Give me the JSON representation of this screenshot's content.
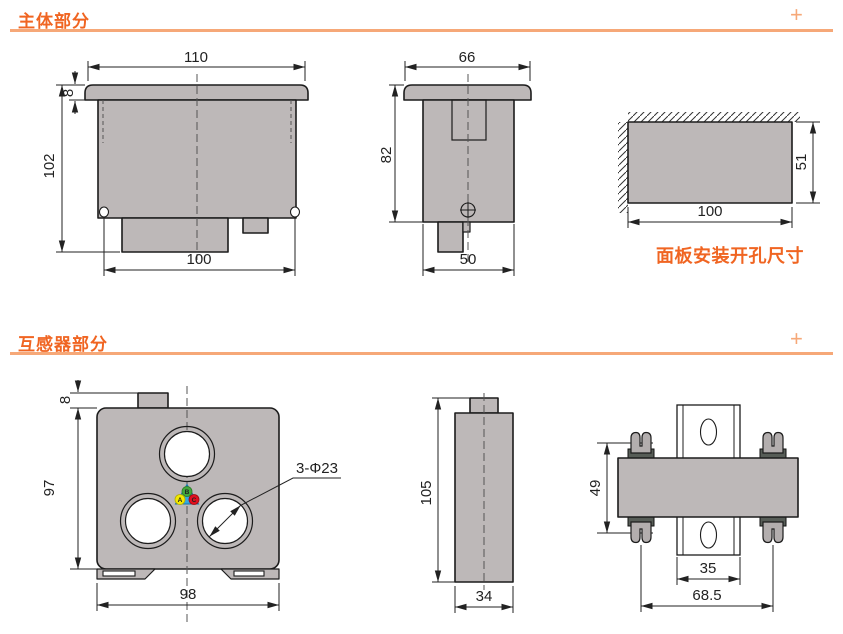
{
  "colors": {
    "accent_orange": "#f06522",
    "accent_orange_light": "#f6a878",
    "drawing_fill_gray": "#bdb8b8",
    "outline_black": "#1c1c1c",
    "clip_dark_gray": "#575d57",
    "phase_triangle_blue": "#35a8e0",
    "phase_a_yellow": "#f2e900",
    "phase_b_green": "#42a83c",
    "phase_c_red": "#e0101e"
  },
  "section_main": {
    "title": "主体部分",
    "expand_icon": "+"
  },
  "section_ct": {
    "title": "互感器部分",
    "expand_icon": "+"
  },
  "main_front": {
    "dim_top_width": "110",
    "dim_bezel_height": "8",
    "dim_total_height": "102",
    "dim_bottom_width": "100"
  },
  "main_side": {
    "dim_top_width": "66",
    "dim_body_height": "82",
    "dim_bottom_width": "50"
  },
  "panel_cutout": {
    "dim_width": "100",
    "dim_height": "51",
    "caption": "面板安装开孔尺寸"
  },
  "ct_front": {
    "dim_tab_height": "8",
    "dim_body_height": "97",
    "dim_bottom_width": "98",
    "hole_label": "3-Φ23",
    "phase_a": "A",
    "phase_b": "B",
    "phase_c": "C"
  },
  "ct_side": {
    "dim_total_height": "105",
    "dim_bottom_width": "34"
  },
  "ct_mount": {
    "dim_clip_vertical_span": "49",
    "dim_rail_width": "35",
    "dim_clip_horizontal_span": "68.5"
  }
}
